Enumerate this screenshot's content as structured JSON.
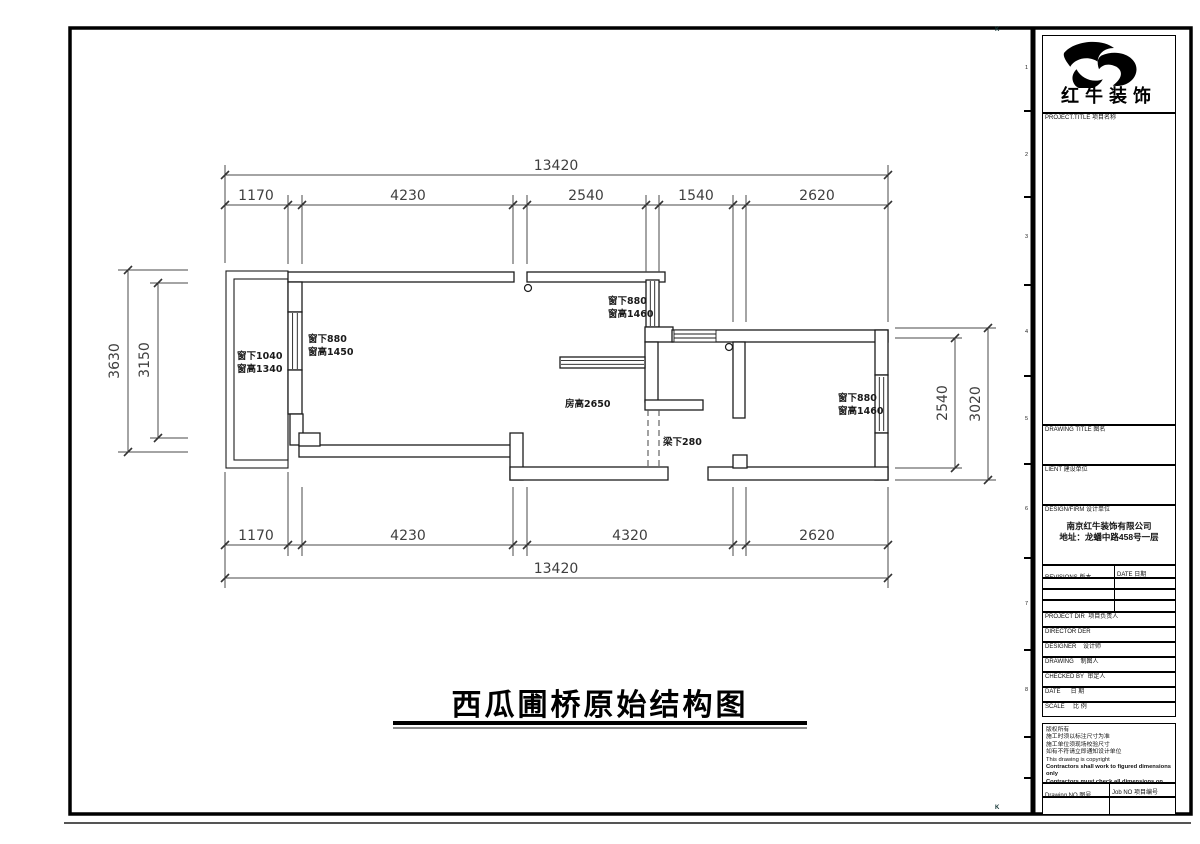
{
  "colors": {
    "ink": "#000000",
    "dim_lines": "#4a4a4a"
  },
  "sheet": {
    "zone_letter_top": "K",
    "zone_letter_bottom": "K",
    "zone_numbers": [
      "1",
      "2",
      "3",
      "4",
      "5",
      "6",
      "7",
      "8"
    ]
  },
  "drawing": {
    "title": "西瓜圃桥原始结构图",
    "dims": {
      "top_total": "13420",
      "top_segments": [
        "1170",
        "4230",
        "2540",
        "1540",
        "2620"
      ],
      "bottom_segments": [
        "1170",
        "4230",
        "4320",
        "2620"
      ],
      "bottom_total": "13420",
      "left_outer": "3630",
      "left_inner": "3150",
      "right_inner": "2540",
      "right_outer": "3020"
    },
    "labels": {
      "balcony_window_line1": "窗下1040",
      "balcony_window_line2": "窗高1340",
      "left_window_line1": "窗下880",
      "left_window_line2": "窗高1450",
      "mid_window_line1": "窗下880",
      "mid_window_line2": "窗高1460",
      "right_window_line1": "窗下880",
      "right_window_line2": "窗高1460",
      "room_height": "房高2650",
      "beam": "梁下280"
    }
  },
  "titleblock": {
    "logo_text": "红牛装饰",
    "project_title_label": "PROJECT.TITLE  项目名称",
    "drawing_title_label": "DRAWING TITLE  图名",
    "client_label": "LIENT  建设单位",
    "design_firm_label": "DESIGN/FIRM  设计单位",
    "company_name": "南京红牛装饰有限公司",
    "company_address": "地址：龙蟠中路458号一层",
    "revisions_label": "REVISIONS  版本",
    "date_col_label": "DATE  日期",
    "rows": [
      {
        "en": "PROJECT DIR",
        "cn": "项目负责人"
      },
      {
        "en": "DIRECTOR DER",
        "cn": ""
      },
      {
        "en": "DESIGNER",
        "cn": "设计师"
      },
      {
        "en": "DRAWING",
        "cn": "制图人"
      },
      {
        "en": "CHECKED BY",
        "cn": "审定人"
      },
      {
        "en": "DATE",
        "cn": "日 期"
      },
      {
        "en": "SCALE",
        "cn": "比 例"
      }
    ],
    "notes": [
      "版权所有",
      "施工时须以标注尺寸为准",
      "施工单位须现场校验尺寸",
      "如有不符请立即通知设计单位",
      "This drawing is copyright"
    ],
    "notes_bold": [
      "Contractors shall work to figured dimensions only",
      "Contractors must check all dimensions on site",
      "Discrepancies must be reported immediately to architects"
    ],
    "drawing_no_label": "Drawing NO  图号",
    "job_no_label": "Job NO  项目编号"
  }
}
